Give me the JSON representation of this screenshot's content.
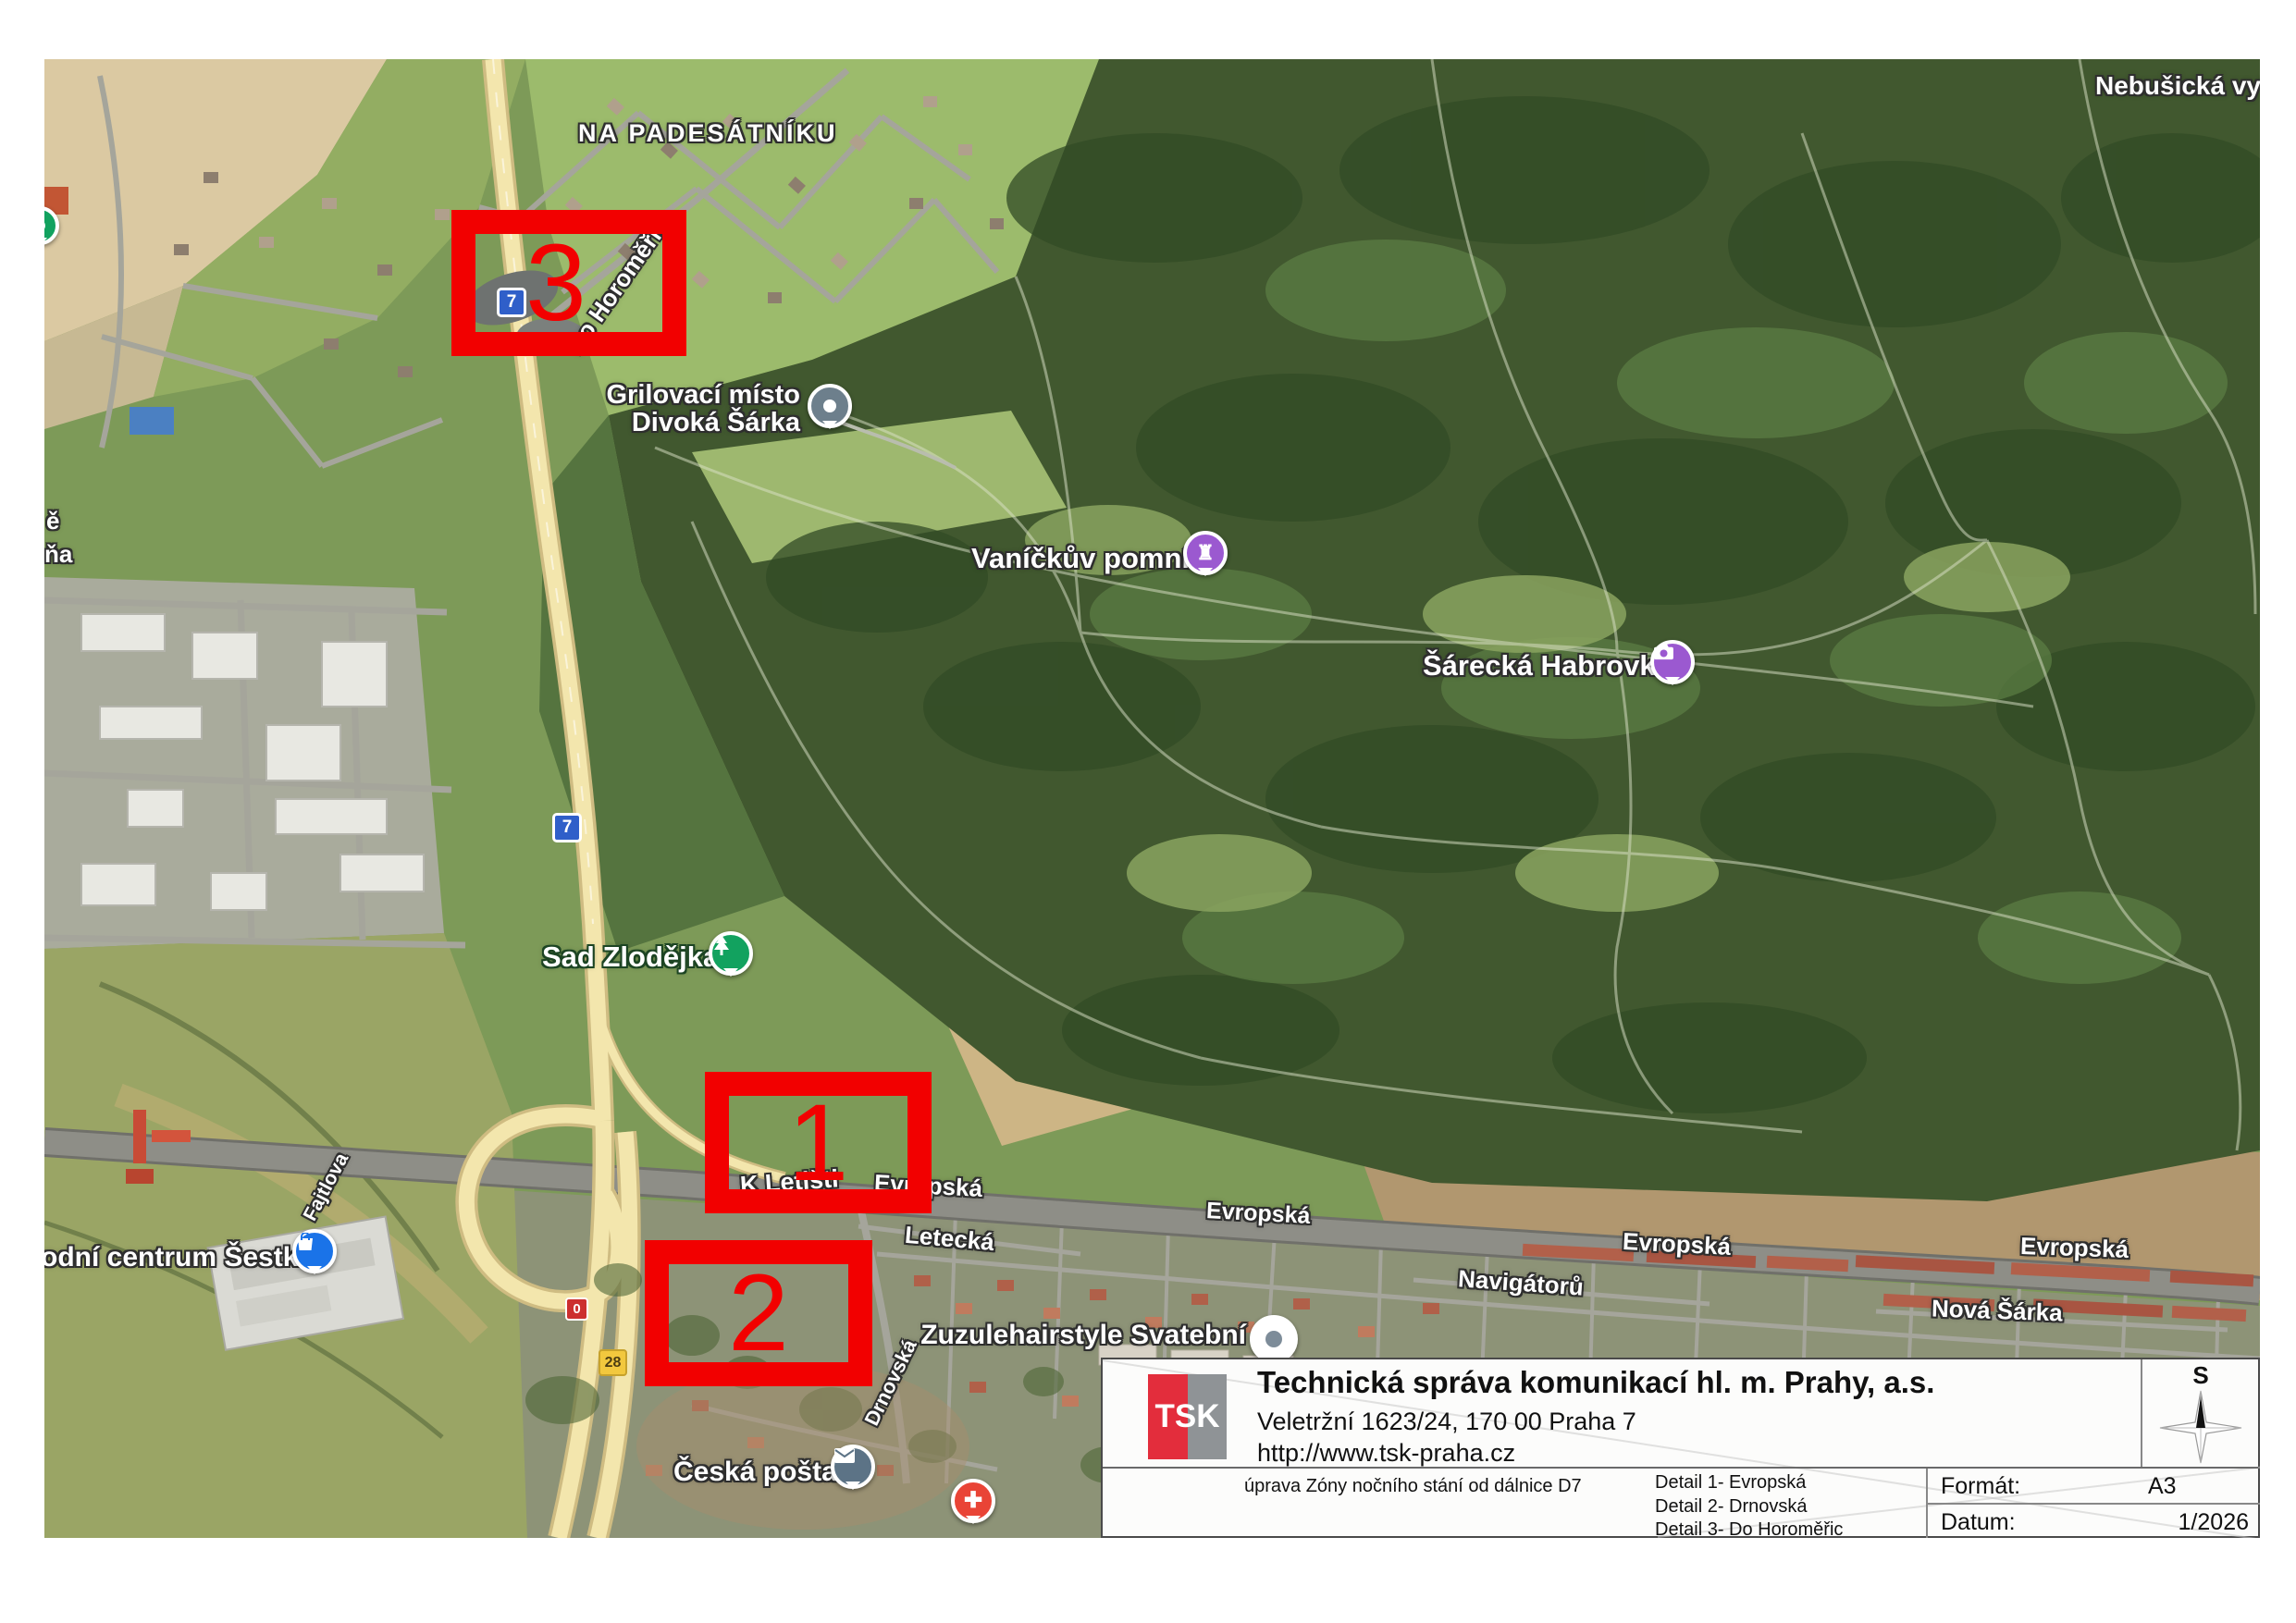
{
  "map": {
    "area_labels": {
      "na_padesatniku": "NA PADESÁTNÍKU",
      "nebusicka": "Nebušická vyh",
      "fragment_e": "ě",
      "fragment_na": "ňa"
    },
    "poi": {
      "grilovaci_line1": "Grilovací místo",
      "grilovaci_line2": "Divoká Šárka",
      "vanickuv": "Vaníčkův pomník",
      "sarecka": "Šárecká Habrovka",
      "sad_zlodejka": "Sad Zlodějka",
      "sestka": "odní centrum Šestka",
      "ceska_posta": "Česká pošta",
      "zuzule": "Zuzulehairstyle Svatební"
    },
    "streets": {
      "do_horomeric": "Do Horoměřic",
      "k_letisti": "K Letišti",
      "evropska": "Evropská",
      "letecka": "Letecká",
      "navigatoru": "Navigátorů",
      "nova_sarka": "Nová Šárka",
      "fajtlova": "Fajtlova",
      "drnovska": "Drnovská"
    },
    "shields": {
      "d7": "7",
      "r0": "0",
      "r28": "28"
    },
    "detail_boxes": {
      "b1": "1",
      "b2": "2",
      "b3": "3"
    }
  },
  "title_block": {
    "logo": "TSK",
    "company": "Technická správa komunikací hl. m. Prahy, a.s.",
    "address": "Veletržní 1623/24, 170 00  Praha 7",
    "url": "http://www.tsk-praha.cz",
    "project": "úprava Zóny nočního stání od dálnice D7",
    "detail1": "Detail 1- Evropská",
    "detail2": "Detail 2- Drnovská",
    "detail3": "Detail 3- Do Horoměřic",
    "format_label": "Formát:",
    "format_value": "A3",
    "date_label": "Datum:",
    "date_value": "1/2026",
    "compass_label": "S"
  }
}
